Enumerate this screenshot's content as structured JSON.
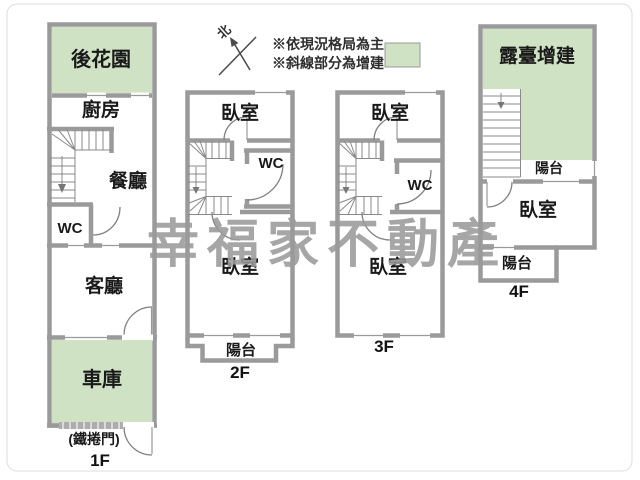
{
  "legend": {
    "compass_label": "北",
    "note1": "※依現況格局為主",
    "note2": "※斜線部分為增建"
  },
  "watermark": {
    "text": "幸福家不動產"
  },
  "colors": {
    "wall_gray": "#9a9a9a",
    "addition_green": "#cfe2c4",
    "watermark_gray": "#9a9a9a",
    "label_text": "#1a1a1a"
  },
  "floors": {
    "f1": {
      "label": "1F",
      "garden": "後花園",
      "kitchen": "廚房",
      "dining": "餐廳",
      "wc": "WC",
      "living": "客廳",
      "garage": "車庫",
      "door_note": "(鐵捲門)"
    },
    "f2": {
      "label": "2F",
      "bedroom_top": "臥室",
      "wc": "WC",
      "bedroom_bottom": "臥室",
      "balcony": "陽台"
    },
    "f3": {
      "label": "3F",
      "bedroom_top": "臥室",
      "wc": "WC",
      "bedroom_bottom": "臥室"
    },
    "f4": {
      "label": "4F",
      "terrace": "露臺增建",
      "balcony_upper": "陽台",
      "bedroom": "臥室",
      "balcony_lower": "陽台"
    }
  }
}
